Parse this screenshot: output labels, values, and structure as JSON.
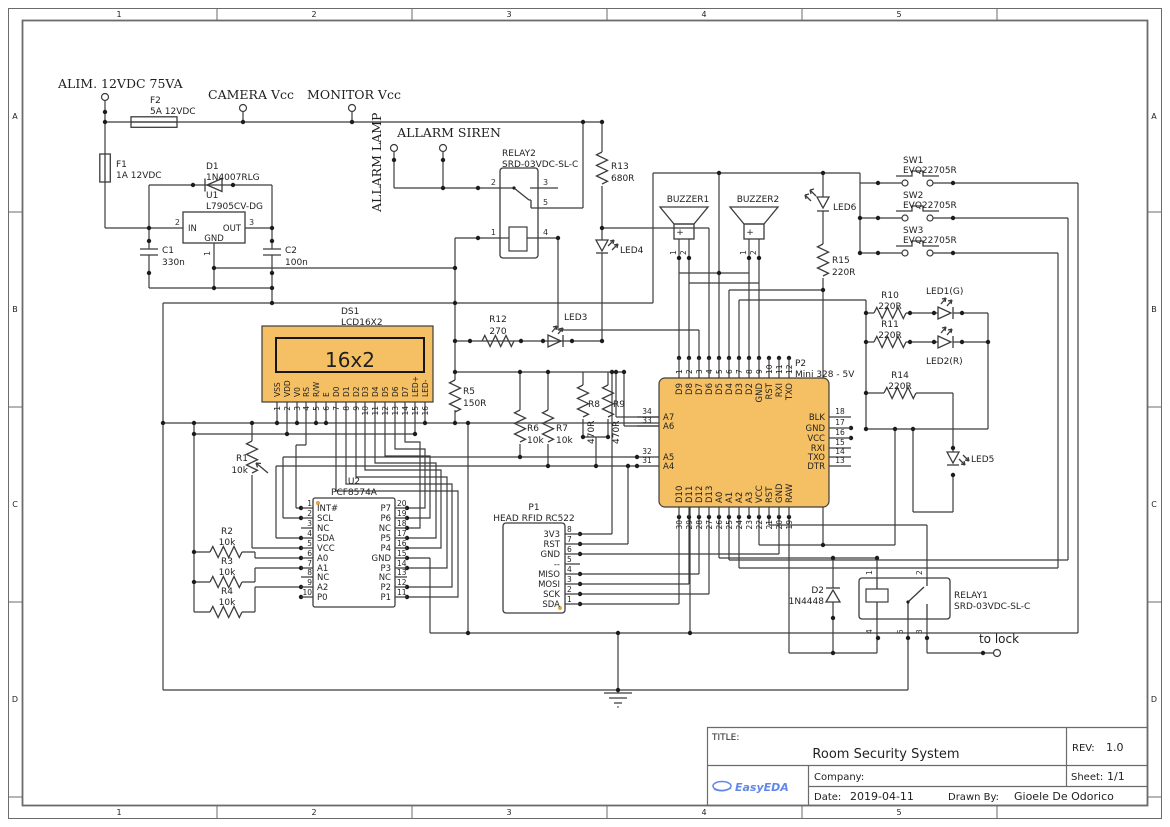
{
  "frame": {
    "cols": [
      "1",
      "2",
      "3",
      "4",
      "5"
    ],
    "rows": [
      "A",
      "B",
      "C",
      "D"
    ]
  },
  "title_block": {
    "title_label": "TITLE:",
    "title": "Room Security System",
    "rev_label": "REV:",
    "rev": "1.0",
    "company_label": "Company:",
    "company": "",
    "sheet_label": "Sheet:",
    "sheet": "1/1",
    "date_label": "Date:",
    "date": "2019-04-11",
    "drawn_label": "Drawn By:",
    "drawn_by": "Gioele De Odorico",
    "logo": "EasyEDA"
  },
  "colors": {
    "part_fill": "#F5C063",
    "wire": "#3c3c3c",
    "logo_blue": "#6287E8"
  },
  "ports": {
    "alim": "ALIM. 12VDC 75VA",
    "camera": "CAMERA Vcc",
    "monitor": "MONITOR Vcc",
    "lamp": "ALLARM LAMP",
    "siren": "ALLARM SIREN",
    "lock": "to lock"
  },
  "parts": {
    "f1": {
      "r": "F1",
      "v": "1A 12VDC"
    },
    "f2": {
      "r": "F2",
      "v": "5A 12VDC"
    },
    "d1": {
      "r": "D1",
      "v": "1N4007RLG"
    },
    "d2": {
      "r": "D2",
      "v": "1N4448"
    },
    "u1": {
      "r": "U1",
      "v": "L7905CV-DG",
      "in": "IN",
      "out": "OUT",
      "gnd": "GND",
      "n1": "1",
      "n2": "2",
      "n3": "3"
    },
    "c1": {
      "r": "C1",
      "v": "330n"
    },
    "c2": {
      "r": "C2",
      "v": "100n"
    },
    "relay2": {
      "r": "RELAY2",
      "v": "SRD-03VDC-SL-C",
      "p1": "1",
      "p2": "2",
      "p3": "3",
      "p4": "4",
      "p5": "5"
    },
    "relay1": {
      "r": "RELAY1",
      "v": "SRD-03VDC-SL-C",
      "p1": "1",
      "p2": "2",
      "p3": "3",
      "p4": "4",
      "p5": "5"
    },
    "r1": {
      "r": "R1",
      "v": "10k"
    },
    "r2": {
      "r": "R2",
      "v": "10k"
    },
    "r3": {
      "r": "R3",
      "v": "10k"
    },
    "r4": {
      "r": "R4",
      "v": "10k"
    },
    "r5": {
      "r": "R5",
      "v": "150R"
    },
    "r6": {
      "r": "R6",
      "v": "10k"
    },
    "r7": {
      "r": "R7",
      "v": "10k"
    },
    "r8": {
      "r": "R8",
      "v": "470R"
    },
    "r9": {
      "r": "R9",
      "v": "470R"
    },
    "r10": {
      "r": "R10",
      "v": "220R"
    },
    "r11": {
      "r": "R11",
      "v": "220R"
    },
    "r12": {
      "r": "R12",
      "v": "270"
    },
    "r13": {
      "r": "R13",
      "v": "680R"
    },
    "r14": {
      "r": "R14",
      "v": "220R"
    },
    "r15": {
      "r": "R15",
      "v": "220R"
    },
    "led1": {
      "r": "LED1(G)"
    },
    "led2": {
      "r": "LED2(R)"
    },
    "led3": {
      "r": "LED3"
    },
    "led4": {
      "r": "LED4"
    },
    "led5": {
      "r": "LED5"
    },
    "led6": {
      "r": "LED6"
    },
    "buzzer1": {
      "r": "BUZZER1",
      "plus": "+",
      "p1": "1",
      "p2": "2"
    },
    "buzzer2": {
      "r": "BUZZER2",
      "plus": "+",
      "p1": "1",
      "p2": "2"
    },
    "sw1": {
      "r": "SW1",
      "v": "EVQ22705R"
    },
    "sw2": {
      "r": "SW2",
      "v": "EVQ22705R"
    },
    "sw3": {
      "r": "SW3",
      "v": "EVQ22705R"
    }
  },
  "ds1": {
    "r": "DS1",
    "v": "LCD16X2",
    "screen": "16x2",
    "pins": [
      "VSS",
      "VDD",
      "V0",
      "RS",
      "R/W",
      "E",
      "D0",
      "D1",
      "D2",
      "D3",
      "D4",
      "D5",
      "D6",
      "D7",
      "LED+",
      "LED-"
    ],
    "nums": [
      "1",
      "2",
      "3",
      "4",
      "5",
      "6",
      "7",
      "8",
      "9",
      "10",
      "11",
      "12",
      "13",
      "14",
      "15",
      "16"
    ]
  },
  "u2": {
    "r": "U2",
    "v": "PCF8574A",
    "left": [
      {
        "n": "1",
        "name": "INT#"
      },
      {
        "n": "2",
        "name": "SCL"
      },
      {
        "n": "3",
        "name": "NC"
      },
      {
        "n": "4",
        "name": "SDA"
      },
      {
        "n": "5",
        "name": "VCC"
      },
      {
        "n": "6",
        "name": "A0"
      },
      {
        "n": "7",
        "name": "A1"
      },
      {
        "n": "8",
        "name": "NC"
      },
      {
        "n": "9",
        "name": "A2"
      },
      {
        "n": "10",
        "name": "P0"
      }
    ],
    "right": [
      {
        "n": "20",
        "name": "P7"
      },
      {
        "n": "19",
        "name": "P6"
      },
      {
        "n": "18",
        "name": "NC"
      },
      {
        "n": "17",
        "name": "P5"
      },
      {
        "n": "16",
        "name": "P4"
      },
      {
        "n": "15",
        "name": "GND"
      },
      {
        "n": "14",
        "name": "P3"
      },
      {
        "n": "13",
        "name": "NC"
      },
      {
        "n": "12",
        "name": "P2"
      },
      {
        "n": "11",
        "name": "P1"
      }
    ]
  },
  "p1": {
    "r": "P1",
    "v": "HEAD RFID RC522",
    "pins": [
      {
        "n": "8",
        "name": "3V3"
      },
      {
        "n": "7",
        "name": "RST"
      },
      {
        "n": "6",
        "name": "GND"
      },
      {
        "n": "5",
        "name": "--"
      },
      {
        "n": "4",
        "name": "MISO"
      },
      {
        "n": "3",
        "name": "MOSI"
      },
      {
        "n": "2",
        "name": "SCK"
      },
      {
        "n": "1",
        "name": "SDA"
      }
    ]
  },
  "p2": {
    "r": "P2",
    "v": "Mini 328 - 5V",
    "top": [
      {
        "n": "1",
        "name": "D9"
      },
      {
        "n": "2",
        "name": "D8"
      },
      {
        "n": "3",
        "name": "D7"
      },
      {
        "n": "4",
        "name": "D6"
      },
      {
        "n": "5",
        "name": "D5"
      },
      {
        "n": "6",
        "name": "D4"
      },
      {
        "n": "7",
        "name": "D3"
      },
      {
        "n": "8",
        "name": "D2"
      },
      {
        "n": "9",
        "name": "GND"
      },
      {
        "n": "10",
        "name": "RST"
      },
      {
        "n": "11",
        "name": "RXI"
      },
      {
        "n": "12",
        "name": "TXO"
      }
    ],
    "left": [
      {
        "n": "34",
        "name": "A7"
      },
      {
        "n": "33",
        "name": "A6"
      },
      {
        "n": "32",
        "name": "A5"
      },
      {
        "n": "31",
        "name": "A4"
      }
    ],
    "right": [
      {
        "n": "18",
        "name": "BLK"
      },
      {
        "n": "17",
        "name": "GND"
      },
      {
        "n": "16",
        "name": "VCC"
      },
      {
        "n": "15",
        "name": "RXI"
      },
      {
        "n": "14",
        "name": "TXO"
      },
      {
        "n": "13",
        "name": "DTR"
      }
    ],
    "bottom": [
      {
        "n": "30",
        "name": "D10"
      },
      {
        "n": "29",
        "name": "D11"
      },
      {
        "n": "28",
        "name": "D12"
      },
      {
        "n": "27",
        "name": "D13"
      },
      {
        "n": "26",
        "name": "A0"
      },
      {
        "n": "25",
        "name": "A1"
      },
      {
        "n": "24",
        "name": "A2"
      },
      {
        "n": "23",
        "name": "A3"
      },
      {
        "n": "22",
        "name": "VCC"
      },
      {
        "n": "21",
        "name": "RST"
      },
      {
        "n": "20",
        "name": "GND"
      },
      {
        "n": "19",
        "name": "RAW"
      }
    ]
  }
}
